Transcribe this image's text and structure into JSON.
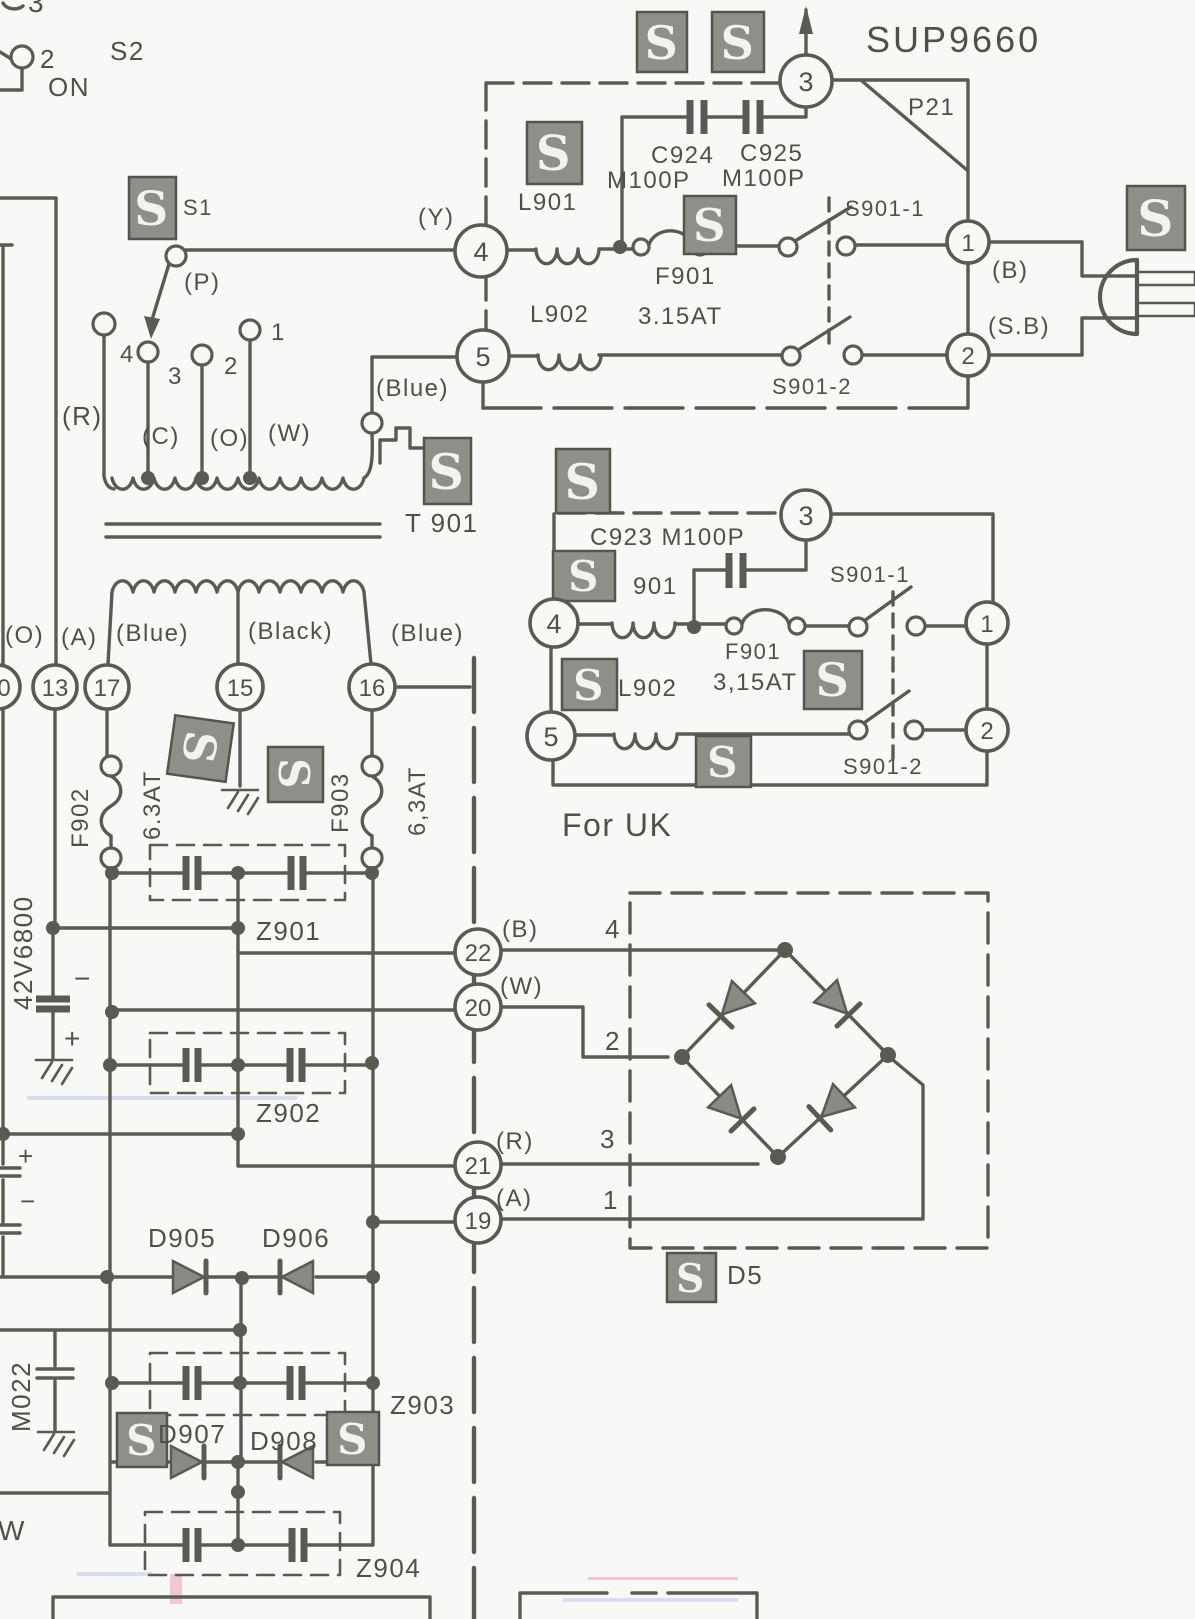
{
  "colors": {
    "ink": "#5a5a54",
    "paper": "#f8f8f6",
    "badge_fill": "#8f8f89",
    "badge_glyph": "#f2f2ee"
  },
  "badge": {
    "s": "S"
  },
  "header": {
    "model": "SUP9660",
    "connector": "P21"
  },
  "top_left": {
    "partial_pin": "3",
    "pin2": "2",
    "switch": "S2",
    "state": "ON"
  },
  "s1": {
    "name": "S1",
    "p": "(P)"
  },
  "mains": {
    "y": "(Y)",
    "pin3": "3",
    "pin4": "4",
    "pin5": "5",
    "pin1": "1",
    "pin2": "2",
    "l901": "L901",
    "l902": "L902",
    "c924": "C924",
    "c925": "C925",
    "c924_val": "M100P",
    "c925_val": "M100P",
    "f901": "F901",
    "f901_val": "3.15AT",
    "s901_1": "S901-1",
    "s901_2": "S901-2",
    "b": "(B)",
    "sb": "(S.B)"
  },
  "transformer": {
    "name": "T 901",
    "tap4": "4",
    "tap3": "3",
    "tap2": "2",
    "tap1": "1",
    "r": "(R)",
    "c": "(C)",
    "o": "(O)",
    "w": "(W)",
    "blue": "(Blue)"
  },
  "uk": {
    "title": "For UK",
    "pin3": "3",
    "pin4": "4",
    "pin5": "5",
    "pin1": "1",
    "pin2": "2",
    "c923": "C923 M100P",
    "l901": "901",
    "f901": "F901",
    "f901_val": "3,15AT",
    "l902": "L902",
    "s901_1": "S901-1",
    "s901_2": "S901-2"
  },
  "secondary": {
    "o": "(O)",
    "a": "(A)",
    "blue_left": "(Blue)",
    "black": "(Black)",
    "blue_right": "(Blue)",
    "pin0": "0",
    "pin13": "13",
    "pin17": "17",
    "pin15": "15",
    "pin16": "16",
    "f902": "F902",
    "f902_val": "6.3AT",
    "f903": "F903",
    "f903_val": "6,3AT",
    "cap_val": "42V6800",
    "minus": "−",
    "plus": "+",
    "plus2": "+",
    "minus2": "−",
    "z901": "Z901",
    "z902": "Z902",
    "z903": "Z903",
    "z904": "Z904",
    "m022": "M022",
    "d905": "D905",
    "d906": "D906",
    "d907": "D907",
    "d908": "D908",
    "w": "W"
  },
  "bridge": {
    "name": "D5",
    "pin22": "22",
    "pin20": "20",
    "pin21": "21",
    "pin19": "19",
    "b": "(B)",
    "w": "(W)",
    "r": "(R)",
    "a": "(A)",
    "t4": "4",
    "t2": "2",
    "t3": "3",
    "t1": "1"
  }
}
